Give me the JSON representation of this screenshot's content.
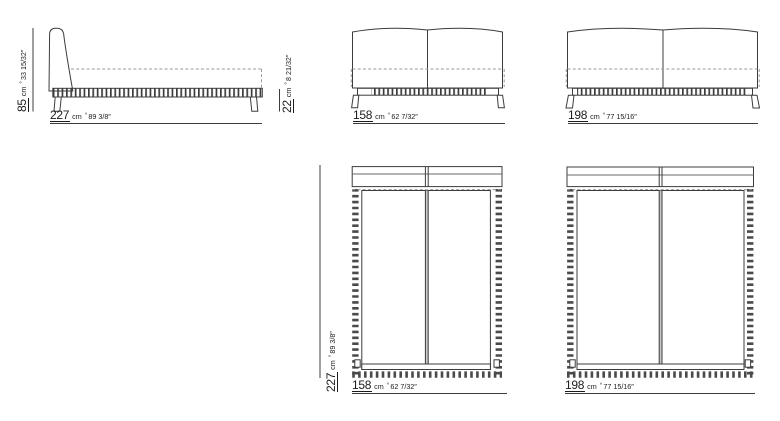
{
  "sheet": {
    "unit": "cm",
    "approx_symbol": "°"
  },
  "side_view": {
    "length_cm": "227",
    "length_in": "89 3/8″",
    "height_cm": "85",
    "height_in": "33 15/32″",
    "base_height_cm": "22",
    "base_height_in": "8 21/32″"
  },
  "front_view_158": {
    "width_cm": "158",
    "width_in": "62 7/32″"
  },
  "front_view_198": {
    "width_cm": "198",
    "width_in": "77 15/16″"
  },
  "top_view_158": {
    "width_cm": "158",
    "width_in": "62 7/32″",
    "length_cm": "227",
    "length_in": "89 3/8″"
  },
  "top_view_198": {
    "width_cm": "198",
    "width_in": "77 15/16″"
  }
}
